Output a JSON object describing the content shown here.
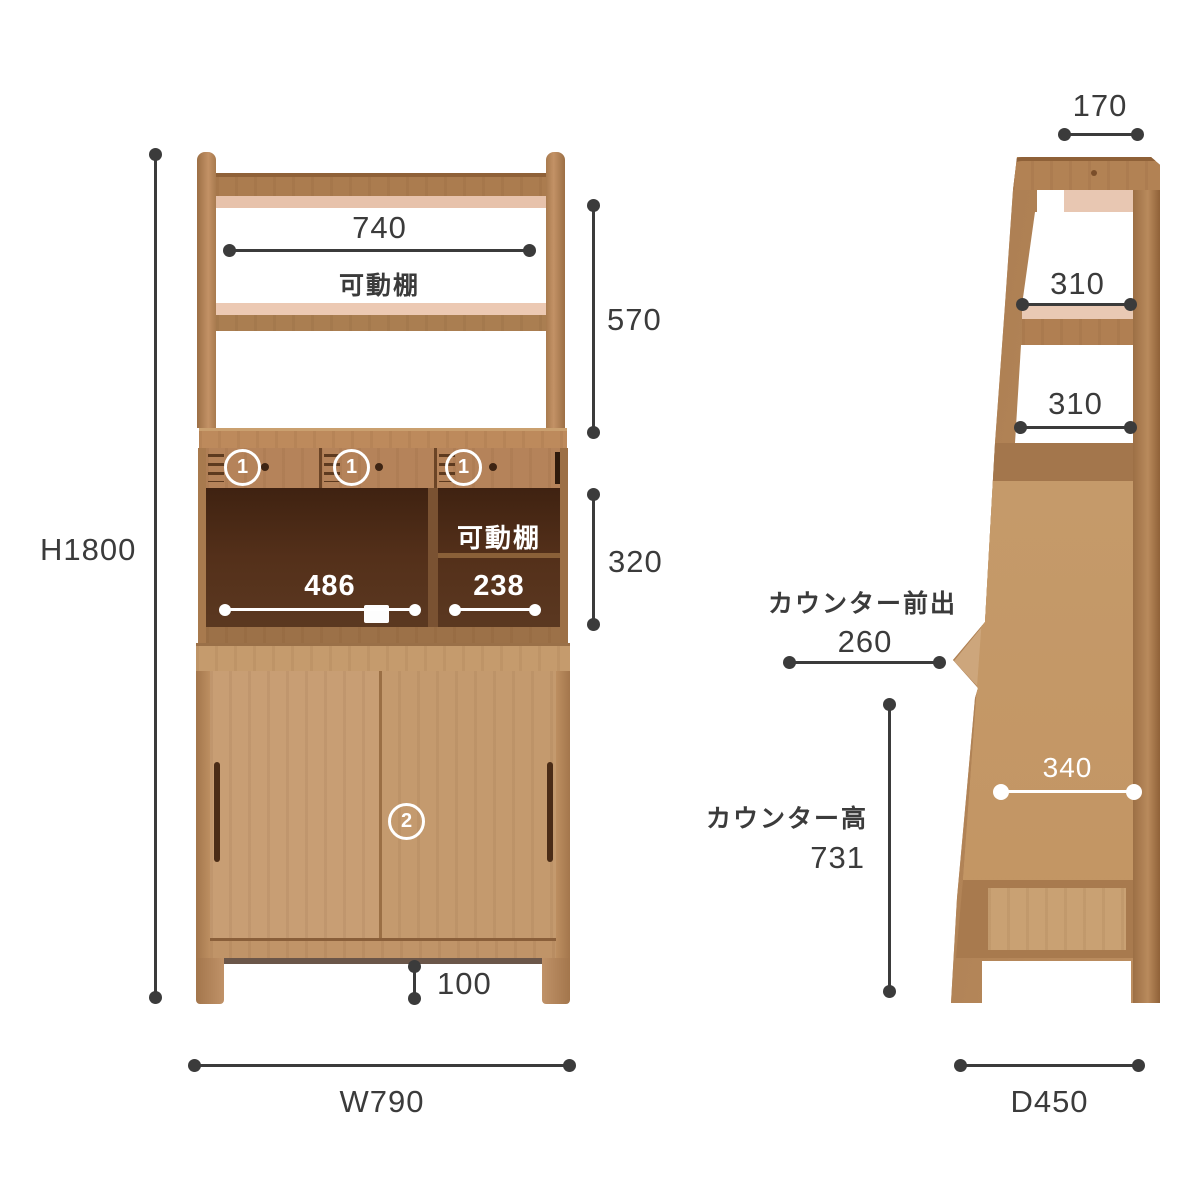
{
  "diagram": {
    "front_view": {
      "overall_height_label": "H1800",
      "overall_width_label": "W790",
      "top_shelf_width": "740",
      "top_movable_shelf_label": "可動棚",
      "upper_section_height": "570",
      "counter_section_height": "320",
      "drawer_marker_number": "1",
      "left_niche_width": "486",
      "middle_movable_shelf_label": "可動棚",
      "right_niche_width": "238",
      "door_marker_number": "2",
      "leg_height": "100"
    },
    "side_view": {
      "top_depth": "170",
      "upper_shelf_depth": "310",
      "lower_shelf_depth": "310",
      "counter_overhang_label": "カウンター前出",
      "counter_overhang_value": "260",
      "counter_height_label": "カウンター高",
      "counter_height_value": "731",
      "side_panel_depth": "340",
      "overall_depth_label": "D450"
    },
    "colors": {
      "wood_light": "#c89e74",
      "wood_mid": "#b08255",
      "wood_dark": "#8f6138",
      "interior_dark": "#4f2c17",
      "highlight_pink": "#e9c8b2",
      "dim_line": "#3b3b3b",
      "white": "#ffffff"
    }
  }
}
